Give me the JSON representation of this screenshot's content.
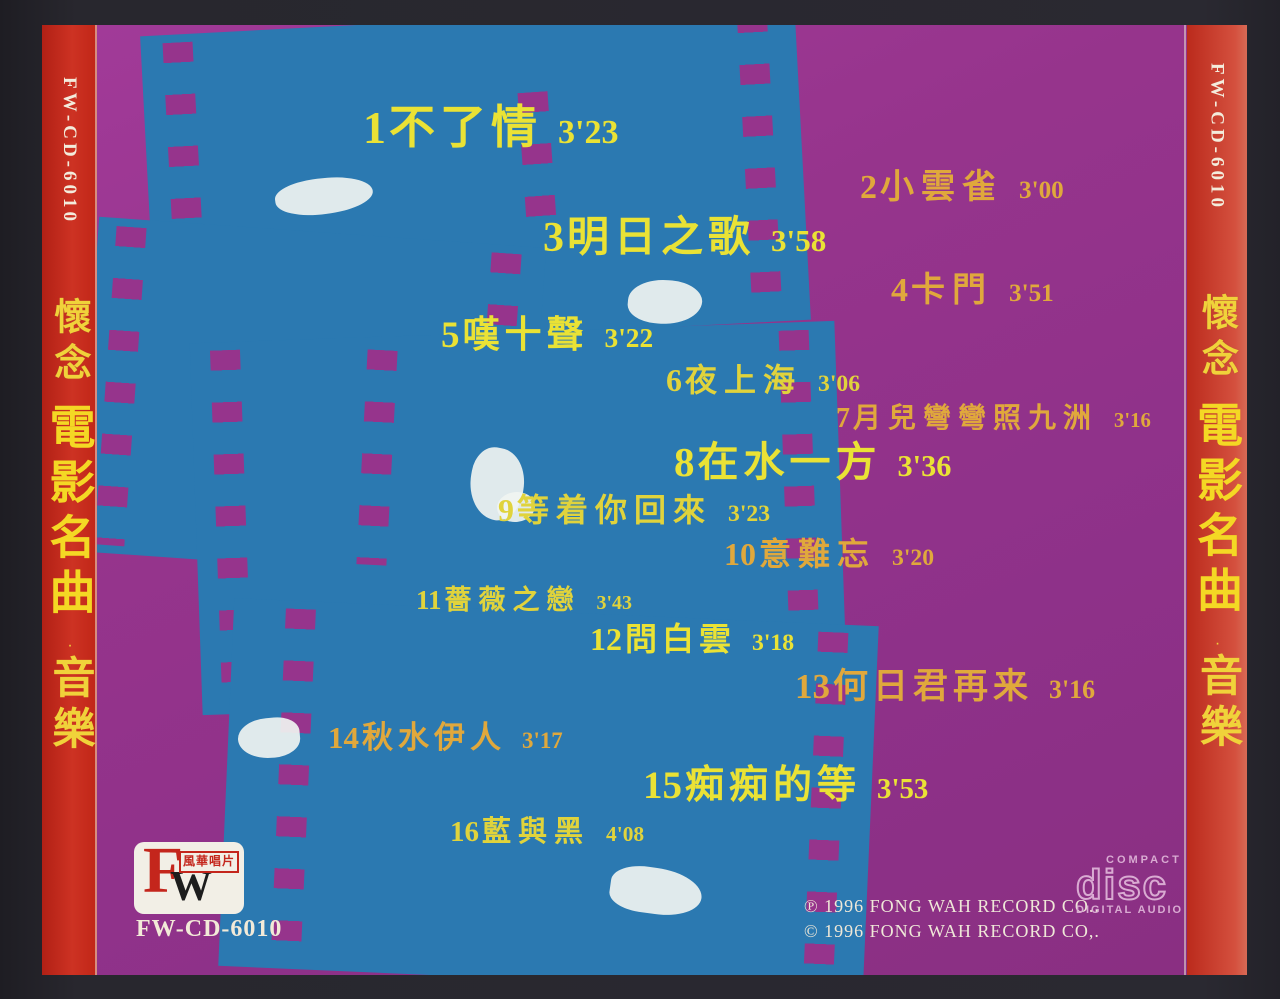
{
  "album": {
    "catalog": "FW-CD-6010",
    "spine": {
      "series": "懷念",
      "title": "電影名曲",
      "dot": "·",
      "suffix": "音樂"
    }
  },
  "tracks": [
    {
      "num": "1",
      "title": "不了情",
      "time": "3'23"
    },
    {
      "num": "2",
      "title": "小雲雀",
      "time": "3'00"
    },
    {
      "num": "3",
      "title": "明日之歌",
      "time": "3'58"
    },
    {
      "num": "4",
      "title": "卡門",
      "time": "3'51"
    },
    {
      "num": "5",
      "title": "嘆十聲",
      "time": "3'22"
    },
    {
      "num": "6",
      "title": "夜上海",
      "time": "3'06"
    },
    {
      "num": "7",
      "title": "月兒彎彎照九洲",
      "time": "3'16"
    },
    {
      "num": "8",
      "title": "在水一方",
      "time": "3'36"
    },
    {
      "num": "9",
      "title": "等着你回來",
      "time": "3'23"
    },
    {
      "num": "10",
      "title": "意難忘",
      "time": "3'20"
    },
    {
      "num": "11",
      "title": "薔薇之戀",
      "time": "3'43"
    },
    {
      "num": "12",
      "title": "問白雲",
      "time": "3'18"
    },
    {
      "num": "13",
      "title": "何日君再来",
      "time": "3'16"
    },
    {
      "num": "14",
      "title": "秋水伊人",
      "time": "3'17"
    },
    {
      "num": "15",
      "title": "痴痴的等",
      "time": "3'53"
    },
    {
      "num": "16",
      "title": "藍與黑",
      "time": "4'08"
    }
  ],
  "footer": {
    "logo_f": "F",
    "logo_w": "W",
    "logo_company": "風華唱片",
    "catalog": "FW-CD-6010",
    "copyright_line1": "℗ 1996 FONG WAH RECORD CO..",
    "copyright_line2": "© 1996 FONG WAH RECORD CO,.",
    "cd_logo": {
      "top": "COMPACT",
      "main": "disc",
      "bottom": "DIGITAL AUDIO"
    }
  },
  "colors": {
    "magenta_bg": "#96348c",
    "film_blue": "#2b79b1",
    "spine_red": "#c62a1d",
    "title_yellow": "#eae235",
    "title_gold": "#e0a83c",
    "text_white": "#efe8d8"
  }
}
